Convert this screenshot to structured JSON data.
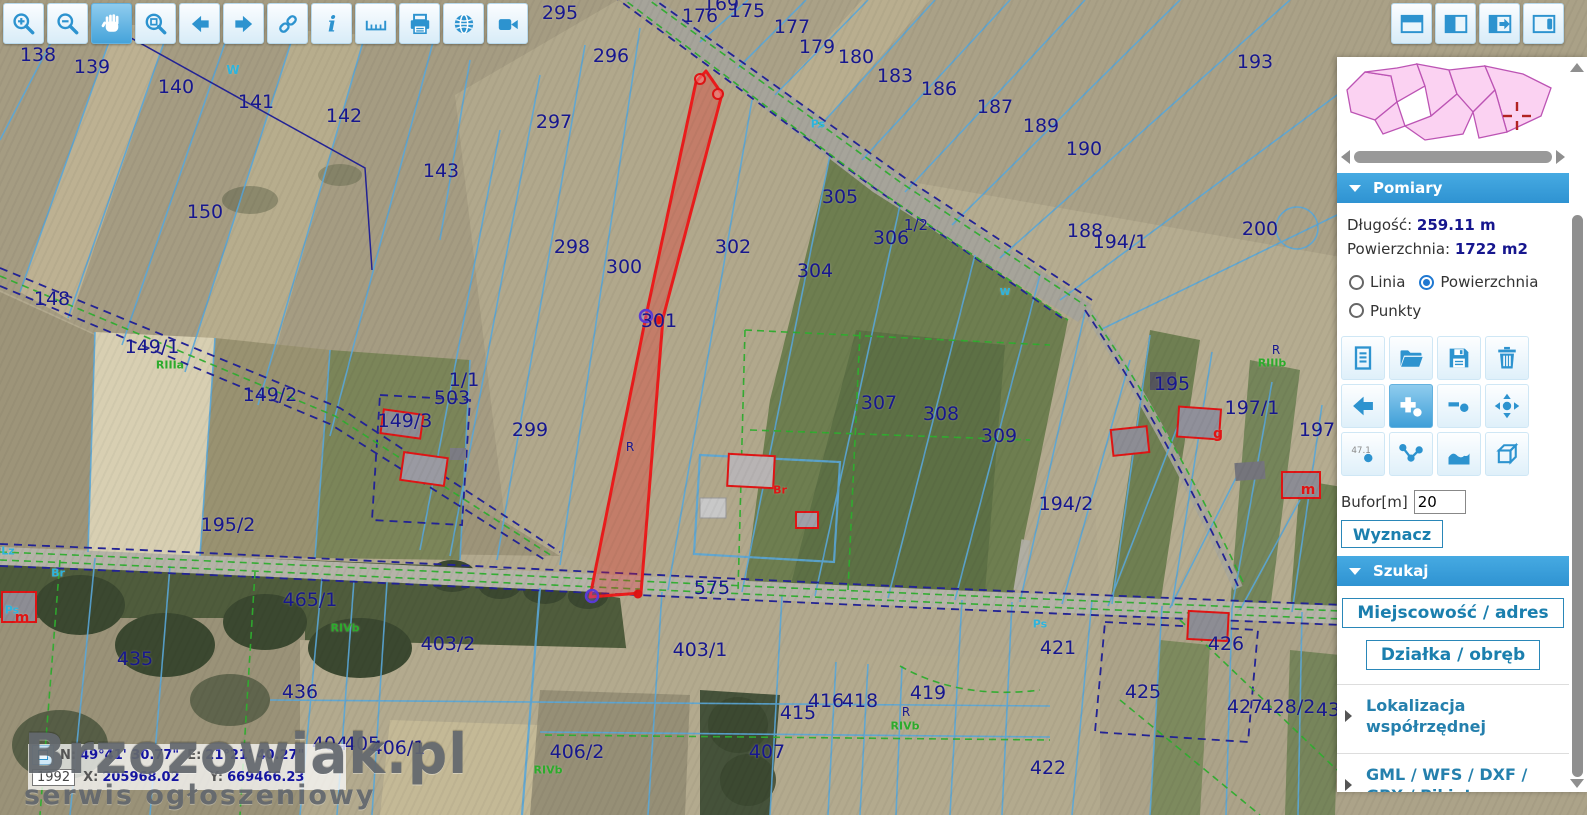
{
  "toolbar": {
    "icons": [
      "zoom-in",
      "zoom-out",
      "pan",
      "zoom-box",
      "back",
      "forward",
      "link",
      "info",
      "measure",
      "print",
      "globe",
      "camera"
    ],
    "active": "pan"
  },
  "layout_buttons": [
    "panel-top",
    "panel-left",
    "panel-expand",
    "panel-right"
  ],
  "sidebar": {
    "pomiary": {
      "title": "Pomiary",
      "length_label": "Długość:",
      "length_value": "259.11 m",
      "area_label": "Powierzchnia:",
      "area_value": "1722 m2",
      "radios": [
        {
          "label": "Linia",
          "checked": false
        },
        {
          "label": "Powierzchnia",
          "checked": true
        },
        {
          "label": "Punkty",
          "checked": false
        }
      ],
      "tools": [
        "new-document",
        "open-folder",
        "save",
        "delete",
        "undo",
        "add-point",
        "remove-point",
        "move-point",
        "show-values",
        "polyline",
        "profile",
        "3d"
      ],
      "buffer_label": "Bufor[m]",
      "buffer_value": "20",
      "wyznacz_label": "Wyznacz"
    },
    "szukaj": {
      "title": "Szukaj",
      "buttons": [
        "Miejscowość / adres",
        "Działka / obręb"
      ],
      "items": [
        "Lokalizacja współrzędnej",
        "GML / WFS / DXF / GPX / Pikiety"
      ]
    }
  },
  "statusbar": {
    "n_label": "N:",
    "n_value": "49°41' 30.77\"",
    "e_label": "E:",
    "e_value": "21°21' 40.27\"",
    "crs": "1992",
    "x_label": "X:",
    "x_value": "205968.02",
    "y_label": "Y:",
    "y_value": "669466.23"
  },
  "watermark": {
    "title": "Brzozowiak.pl",
    "subtitle": "serwis ogłoszeniowy"
  },
  "map": {
    "measurement": {
      "length": "259.11 m",
      "area": "1722 m2",
      "highlight_color": "#ea1c1c"
    },
    "labels": [
      {
        "t": "138",
        "x": 38,
        "y": 55
      },
      {
        "t": "139",
        "x": 92,
        "y": 67
      },
      {
        "t": "140",
        "x": 176,
        "y": 87
      },
      {
        "t": "141",
        "x": 256,
        "y": 102
      },
      {
        "t": "142",
        "x": 344,
        "y": 116
      },
      {
        "t": "143",
        "x": 441,
        "y": 171
      },
      {
        "t": "150",
        "x": 205,
        "y": 212
      },
      {
        "t": "148",
        "x": 52,
        "y": 299
      },
      {
        "t": "149/1",
        "x": 152,
        "y": 347
      },
      {
        "t": "149/2",
        "x": 270,
        "y": 395
      },
      {
        "t": "149/3",
        "x": 405,
        "y": 421
      },
      {
        "t": "1/1",
        "x": 464,
        "y": 380
      },
      {
        "t": "503",
        "x": 452,
        "y": 398
      },
      {
        "t": "299",
        "x": 530,
        "y": 430
      },
      {
        "t": "195/2",
        "x": 228,
        "y": 525
      },
      {
        "t": "465/1",
        "x": 310,
        "y": 600
      },
      {
        "t": "435",
        "x": 135,
        "y": 659
      },
      {
        "t": "436",
        "x": 300,
        "y": 692
      },
      {
        "t": "403/2",
        "x": 448,
        "y": 644
      },
      {
        "t": "403/1",
        "x": 700,
        "y": 650
      },
      {
        "t": "404",
        "x": 330,
        "y": 744
      },
      {
        "t": "405",
        "x": 362,
        "y": 744
      },
      {
        "t": "406/1",
        "x": 398,
        "y": 748
      },
      {
        "t": "406/2",
        "x": 577,
        "y": 752
      },
      {
        "t": "407",
        "x": 767,
        "y": 752
      },
      {
        "t": "415",
        "x": 798,
        "y": 713
      },
      {
        "t": "416",
        "x": 826,
        "y": 701
      },
      {
        "t": "418",
        "x": 860,
        "y": 701
      },
      {
        "t": "419",
        "x": 928,
        "y": 693
      },
      {
        "t": "421",
        "x": 1058,
        "y": 648
      },
      {
        "t": "422",
        "x": 1048,
        "y": 768
      },
      {
        "t": "425",
        "x": 1143,
        "y": 692
      },
      {
        "t": "426",
        "x": 1226,
        "y": 644
      },
      {
        "t": "427",
        "x": 1245,
        "y": 707
      },
      {
        "t": "428/2",
        "x": 1288,
        "y": 707
      },
      {
        "t": "43",
        "x": 1328,
        "y": 710
      },
      {
        "t": "295",
        "x": 560,
        "y": 13
      },
      {
        "t": "296",
        "x": 611,
        "y": 56
      },
      {
        "t": "297",
        "x": 554,
        "y": 122
      },
      {
        "t": "298",
        "x": 572,
        "y": 247
      },
      {
        "t": "300",
        "x": 624,
        "y": 267
      },
      {
        "t": "301",
        "x": 659,
        "y": 321
      },
      {
        "t": "302",
        "x": 733,
        "y": 247
      },
      {
        "t": "304",
        "x": 815,
        "y": 271
      },
      {
        "t": "305",
        "x": 840,
        "y": 197
      },
      {
        "t": "306",
        "x": 891,
        "y": 238
      },
      {
        "t": "1/2",
        "x": 916,
        "y": 225,
        "s": 15
      },
      {
        "t": "307",
        "x": 879,
        "y": 403
      },
      {
        "t": "308",
        "x": 941,
        "y": 414
      },
      {
        "t": "309",
        "x": 999,
        "y": 436
      },
      {
        "t": "169",
        "x": 721,
        "y": 4
      },
      {
        "t": "176",
        "x": 700,
        "y": 16
      },
      {
        "t": "175",
        "x": 747,
        "y": 11
      },
      {
        "t": "177",
        "x": 792,
        "y": 27
      },
      {
        "t": "179",
        "x": 817,
        "y": 47
      },
      {
        "t": "180",
        "x": 856,
        "y": 57
      },
      {
        "t": "183",
        "x": 895,
        "y": 76
      },
      {
        "t": "186",
        "x": 939,
        "y": 89
      },
      {
        "t": "187",
        "x": 995,
        "y": 107
      },
      {
        "t": "189",
        "x": 1041,
        "y": 126
      },
      {
        "t": "190",
        "x": 1084,
        "y": 149
      },
      {
        "t": "193",
        "x": 1255,
        "y": 62
      },
      {
        "t": "188",
        "x": 1085,
        "y": 231
      },
      {
        "t": "194/1",
        "x": 1120,
        "y": 242
      },
      {
        "t": "200",
        "x": 1260,
        "y": 229
      },
      {
        "t": "195",
        "x": 1172,
        "y": 384
      },
      {
        "t": "197/1",
        "x": 1252,
        "y": 408
      },
      {
        "t": "197",
        "x": 1317,
        "y": 430
      },
      {
        "t": "194/2",
        "x": 1066,
        "y": 504
      },
      {
        "t": "575",
        "x": 712,
        "y": 588
      },
      {
        "t": "W",
        "x": 233,
        "y": 70,
        "c": "cyan",
        "s": 12
      },
      {
        "t": "w",
        "x": 1005,
        "y": 291,
        "c": "cyan",
        "s": 12
      },
      {
        "t": "Ps",
        "x": 818,
        "y": 124,
        "c": "cyan",
        "s": 11
      },
      {
        "t": "Ps",
        "x": 1040,
        "y": 624,
        "c": "cyan",
        "s": 11
      },
      {
        "t": "Ps",
        "x": 12,
        "y": 610,
        "c": "cyan",
        "s": 11
      },
      {
        "t": "Br",
        "x": 58,
        "y": 573,
        "c": "cyan",
        "s": 11
      },
      {
        "t": "Lz",
        "x": 8,
        "y": 551,
        "c": "cyan",
        "s": 11
      },
      {
        "t": "R",
        "x": 906,
        "y": 712,
        "s": 12
      },
      {
        "t": "R",
        "x": 1276,
        "y": 350,
        "s": 12
      },
      {
        "t": "R",
        "x": 630,
        "y": 447,
        "s": 12
      },
      {
        "t": "RIIIa",
        "x": 170,
        "y": 365,
        "c": "green",
        "s": 11
      },
      {
        "t": "RIVb",
        "x": 345,
        "y": 628,
        "c": "green",
        "s": 11
      },
      {
        "t": "RIVb",
        "x": 548,
        "y": 770,
        "c": "green",
        "s": 11
      },
      {
        "t": "RIVb",
        "x": 905,
        "y": 726,
        "c": "green",
        "s": 11
      },
      {
        "t": "RIIIb",
        "x": 1272,
        "y": 363,
        "c": "green",
        "s": 11
      },
      {
        "t": "m",
        "x": 22,
        "y": 618,
        "c": "red",
        "s": 14
      },
      {
        "t": "Br",
        "x": 780,
        "y": 490,
        "c": "red",
        "s": 11
      },
      {
        "t": "m",
        "x": 1308,
        "y": 490,
        "c": "red",
        "s": 14
      },
      {
        "t": "g",
        "x": 1218,
        "y": 434,
        "c": "red",
        "s": 14
      }
    ]
  }
}
